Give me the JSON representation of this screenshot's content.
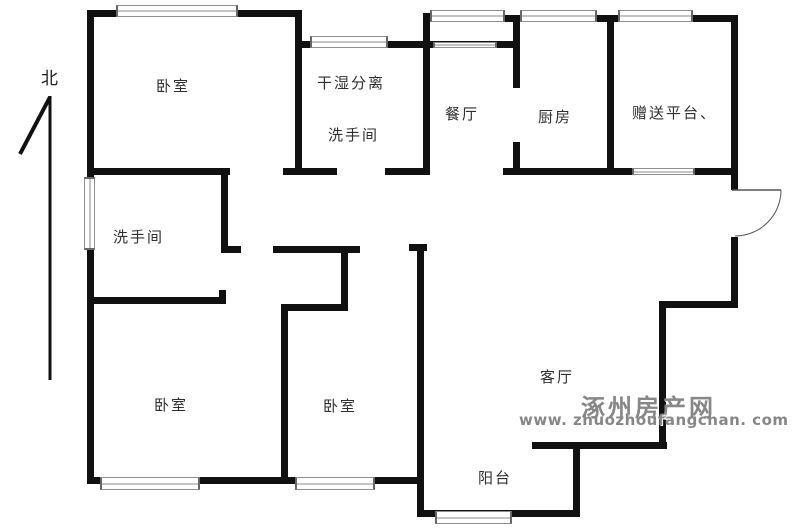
{
  "compass": {
    "label": "北"
  },
  "rooms": {
    "bedroom_top": "卧室",
    "dry_wet_separation": "干湿分离",
    "washroom_upper": "洗手间",
    "dining_room": "餐厅",
    "kitchen": "厨房",
    "bonus_platform": "赠送平台、",
    "washroom_lower": "洗手间",
    "bedroom_left": "卧室",
    "bedroom_middle": "卧室",
    "living_room": "客厅",
    "balcony": "阳台"
  },
  "watermark": {
    "site_name": "涿州房产网",
    "site_url": "www. zhuozhoufangchan. com"
  },
  "colors": {
    "wall": "#111111",
    "label": "#2f2f2f",
    "watermark": "#878787",
    "window_border": "#8f8f8f",
    "background": "#ffffff"
  }
}
